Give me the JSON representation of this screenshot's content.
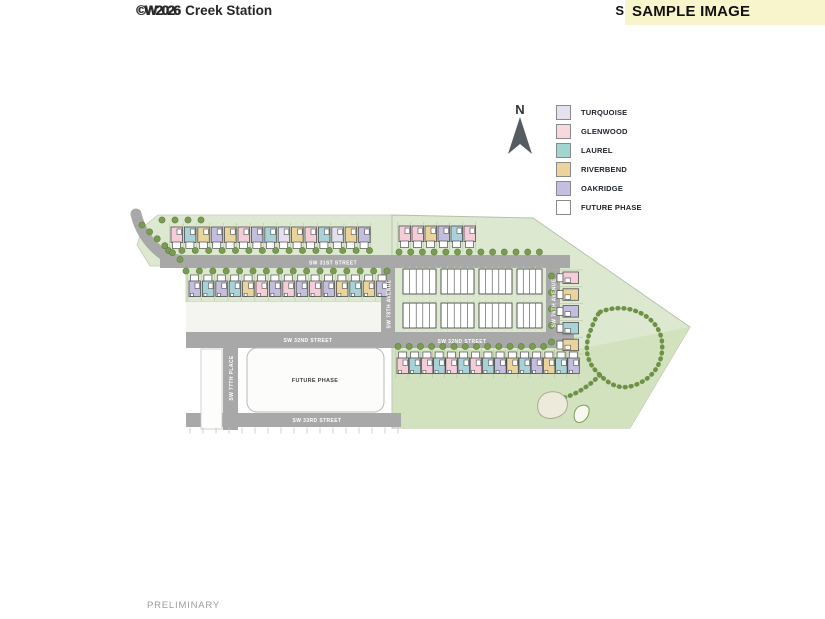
{
  "header": {
    "title_prefix": "©W2026",
    "title": "Creek Station",
    "sample_prefix": "S",
    "sample_label": "SAMPLE IMAGE"
  },
  "compass": {
    "label": "N"
  },
  "legend": {
    "items": [
      {
        "label": "TURQUOISE",
        "color": "#E6E1F0"
      },
      {
        "label": "GLENWOOD",
        "color": "#F8D7DE"
      },
      {
        "label": "LAUREL",
        "color": "#A2D4D0"
      },
      {
        "label": "RIVERBEND",
        "color": "#ECD39B"
      },
      {
        "label": "OAKRIDGE",
        "color": "#C4BFE2"
      },
      {
        "label": "FUTURE PHASE",
        "color": "#FFFFFF"
      }
    ]
  },
  "footer": {
    "label": "PRELIMINARY"
  },
  "map": {
    "streets": {
      "sw31": {
        "label": "SW 31ST STREET"
      },
      "sw32_left": {
        "label": "SW 32ND STREET"
      },
      "sw32_right": {
        "label": "SW 32ND STREET"
      },
      "sw33": {
        "label": "SW 33RD STREET"
      },
      "sw77pl": {
        "label": "SW 77TH PLACE"
      },
      "sw78av": {
        "label": "SW 78TH AVENUE"
      },
      "sw76av": {
        "label": "SW 76TH AVENUE"
      }
    },
    "future_phase": {
      "label": "FUTURE PHASE"
    },
    "palette": {
      "glenwood": "#F4CDD9",
      "laurel": "#A9D2D8",
      "turquoise": "#E4DFEE",
      "riverbend": "#EBD39C",
      "oakridge": "#C3BDDF",
      "road": "#A8A8A8",
      "green": "#DCE8CF",
      "park": "#D2E2BE",
      "tree": "#7B9B53",
      "tree_edge": "#5F7E41",
      "outline": "#4F4F4F",
      "lotline": "#B3BFA3"
    },
    "house_rows": [
      {
        "id": "north-row",
        "orient": "h",
        "pad": "bottom",
        "x": 171,
        "y": 227,
        "pitch": 13.4,
        "colors": [
          "glenwood",
          "laurel",
          "riverbend",
          "oakridge",
          "riverbend",
          "glenwood",
          "oakridge",
          "laurel",
          "turquoise",
          "riverbend",
          "glenwood",
          "laurel",
          "turquoise",
          "riverbend",
          "oakridge"
        ]
      },
      {
        "id": "second-row",
        "orient": "h",
        "pad": "top",
        "x": 189,
        "y": 275,
        "pitch": 13.4,
        "colors": [
          "oakridge",
          "laurel",
          "oakridge",
          "laurel",
          "riverbend",
          "glenwood",
          "oakridge",
          "glenwood",
          "oakridge",
          "glenwood",
          "oakridge",
          "riverbend",
          "laurel",
          "riverbend",
          "oakridge"
        ]
      },
      {
        "id": "northeast-row",
        "orient": "h",
        "pad": "bottom",
        "x": 399,
        "y": 226,
        "pitch": 13.0,
        "colors": [
          "glenwood",
          "glenwood",
          "riverbend",
          "oakridge",
          "laurel",
          "glenwood"
        ]
      },
      {
        "id": "south-row",
        "orient": "h",
        "pad": "top",
        "x": 397,
        "y": 352,
        "pitch": 12.2,
        "colors": [
          "glenwood",
          "laurel",
          "glenwood",
          "laurel",
          "glenwood",
          "laurel",
          "glenwood",
          "laurel",
          "oakridge",
          "riverbend",
          "laurel",
          "oakridge",
          "riverbend",
          "laurel",
          "oakridge"
        ]
      },
      {
        "id": "east-column",
        "orient": "v",
        "pad": "left",
        "x": 557,
        "y": 272,
        "pitch": 16.8,
        "colors": [
          "glenwood",
          "riverbend",
          "oakridge",
          "laurel",
          "riverbend"
        ]
      }
    ],
    "tree_rows": [
      {
        "x": 168.5,
        "y": 250.5,
        "dx": 13.4,
        "dy": 0,
        "count": 16
      },
      {
        "x": 186.0,
        "y": 271.0,
        "dx": 13.4,
        "dy": 0,
        "count": 16
      },
      {
        "x": 399.0,
        "y": 252.0,
        "dx": 11.7,
        "dy": 0,
        "count": 13
      },
      {
        "x": 398.0,
        "y": 346.5,
        "dx": 11.2,
        "dy": 0,
        "count": 14
      },
      {
        "x": 142.0,
        "y": 225.0,
        "dx": 7.6,
        "dy": 6.9,
        "count": 6
      },
      {
        "x": 162.0,
        "y": 220.0,
        "dx": 13.0,
        "dy": 0,
        "count": 4
      },
      {
        "x": 551.5,
        "y": 276.0,
        "dx": 0,
        "dy": 16.5,
        "count": 5
      }
    ],
    "townhome_bands": [
      {
        "y": 266,
        "h": 31,
        "blocks": [
          {
            "x": 403,
            "w": 33,
            "units": 5
          },
          {
            "x": 441,
            "w": 33,
            "units": 5
          },
          {
            "x": 479,
            "w": 33,
            "units": 5
          },
          {
            "x": 517,
            "w": 25,
            "units": 4
          }
        ]
      },
      {
        "y": 300,
        "h": 31,
        "blocks": [
          {
            "x": 403,
            "w": 33,
            "units": 5
          },
          {
            "x": 441,
            "w": 33,
            "units": 5
          },
          {
            "x": 479,
            "w": 33,
            "units": 5
          },
          {
            "x": 517,
            "w": 25,
            "units": 4
          }
        ]
      }
    ],
    "tick_rows": [
      {
        "x": 190,
        "y": 427.5,
        "step": 13,
        "count": 17,
        "len": 6
      }
    ]
  }
}
